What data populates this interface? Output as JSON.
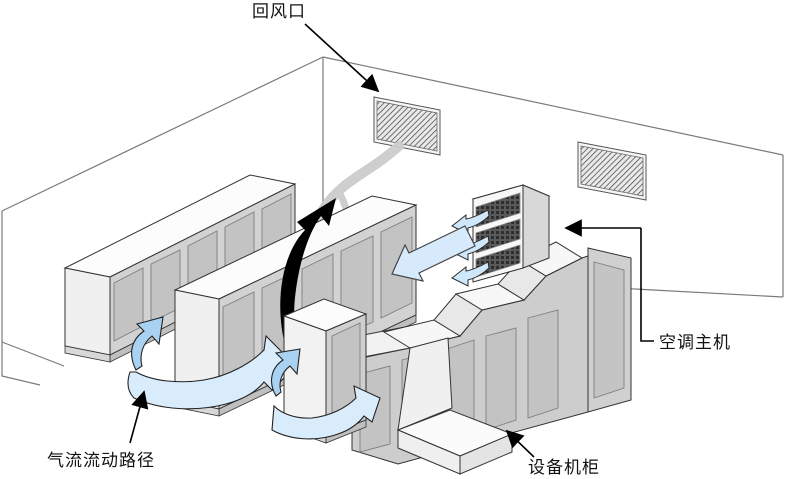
{
  "diagram": {
    "title_semantic": "server-room-airflow-diagram",
    "labels": {
      "return_air_vent": "回风口",
      "ac_main_unit": "空调主机",
      "airflow_path": "气流流动路径",
      "equipment_cabinet": "设备机柜"
    },
    "colors": {
      "airflow_ribbon_light": "#d9ecfb",
      "airflow_ribbon_dark": "#a9d2f2",
      "cabinet_face": "#d2d2d2",
      "cabinet_panel": "#c3c3c3",
      "cabinet_top": "#fcfcfc",
      "wall_line": "#777777",
      "outline": "#333333",
      "vent_hatch": "#3d3d3d",
      "hot_air_arrow": "#000000",
      "hot_air_stream": "#cccccc"
    }
  }
}
